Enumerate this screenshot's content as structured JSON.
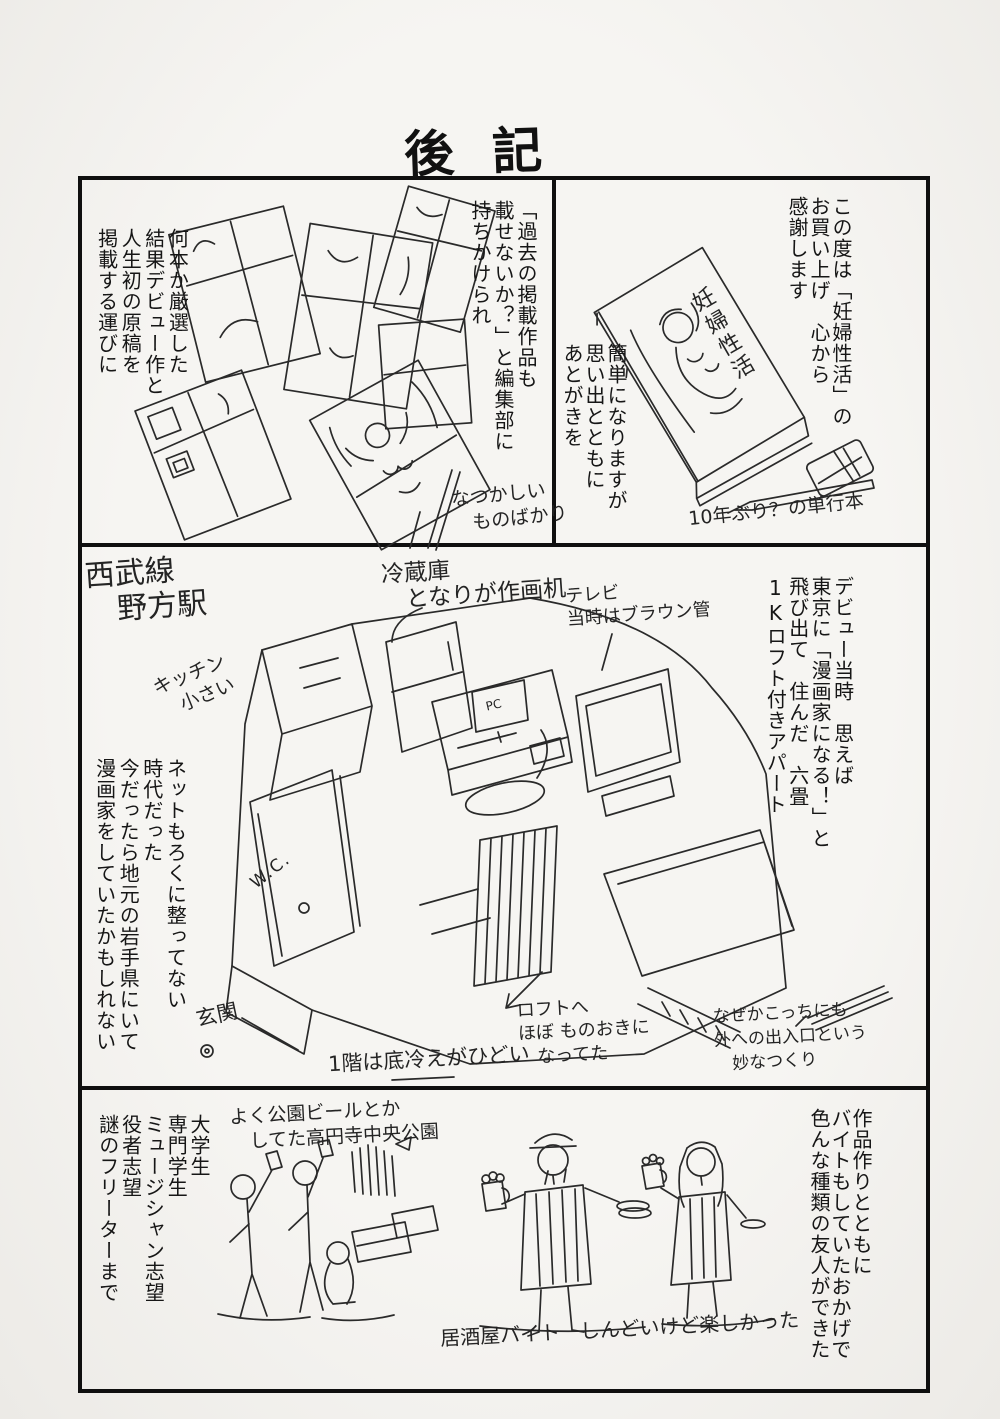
{
  "title": "後記",
  "colors": {
    "ink": "#1a1a1a",
    "paper": "#f6f5f2"
  },
  "top_left_panel": {
    "editor_text": "「過去の掲載作品も\n載せないか？」と編集部に\n持ちかけられ",
    "result_text": "何本か厳選した\n結果デビュー作と\n人生初の原稿を\n掲載する運びに",
    "nostalgia_note": "なつかしい\n　ものばかり"
  },
  "top_right_panel": {
    "thanks_text": "この度は「妊婦性活」の\nお買い上げ　心から\n感謝します",
    "afterword_text": "簡単になりますが\n思い出とともに\nあとがきを",
    "book_title": "妊婦性活",
    "tankobon_note": "10年ぶり？の単行本"
  },
  "middle_panel": {
    "station_note": "西武線\n　野方駅",
    "fridge_note": "冷蔵庫\n　となりが作画机",
    "tv_note": "テレビ\n当時はブラウン管",
    "kitchen_note": "キッチン\n　小さい",
    "debut_text": "デビュー当時　思えば\n東京に「漫画家になる！」と\n飛び出て　住んだ　六畳\n1Kロフト付きアパート",
    "internet_text": "ネットもろくに整ってない\n時代だった\n今だったら地元の岩手県にいて\n漫画家をしていたかもしれない",
    "wc_label": "W.C.",
    "pc_label": "PC",
    "entrance_note": "玄関",
    "loft_note": "ロフトへ\nほぼ ものおきに\n　なってた",
    "cold_floor_note": "1階は底冷えがひどい",
    "exit_note": "なぜかこっちにも\n外への出入口という\n　妙なつくり"
  },
  "bottom_panel": {
    "park_note": "よく公園ビールとか\n　してた高円寺中央公園",
    "friends_text": "作品作りとともに\nバイトもしていたおかげで\n色んな種類の友人ができた",
    "people_text": "大学生\n専門学生\nミュージシャン志望\n役者志望\n謎のフリーターまで",
    "izakaya_note": "居酒屋バイト　しんどいけど楽しかった"
  }
}
